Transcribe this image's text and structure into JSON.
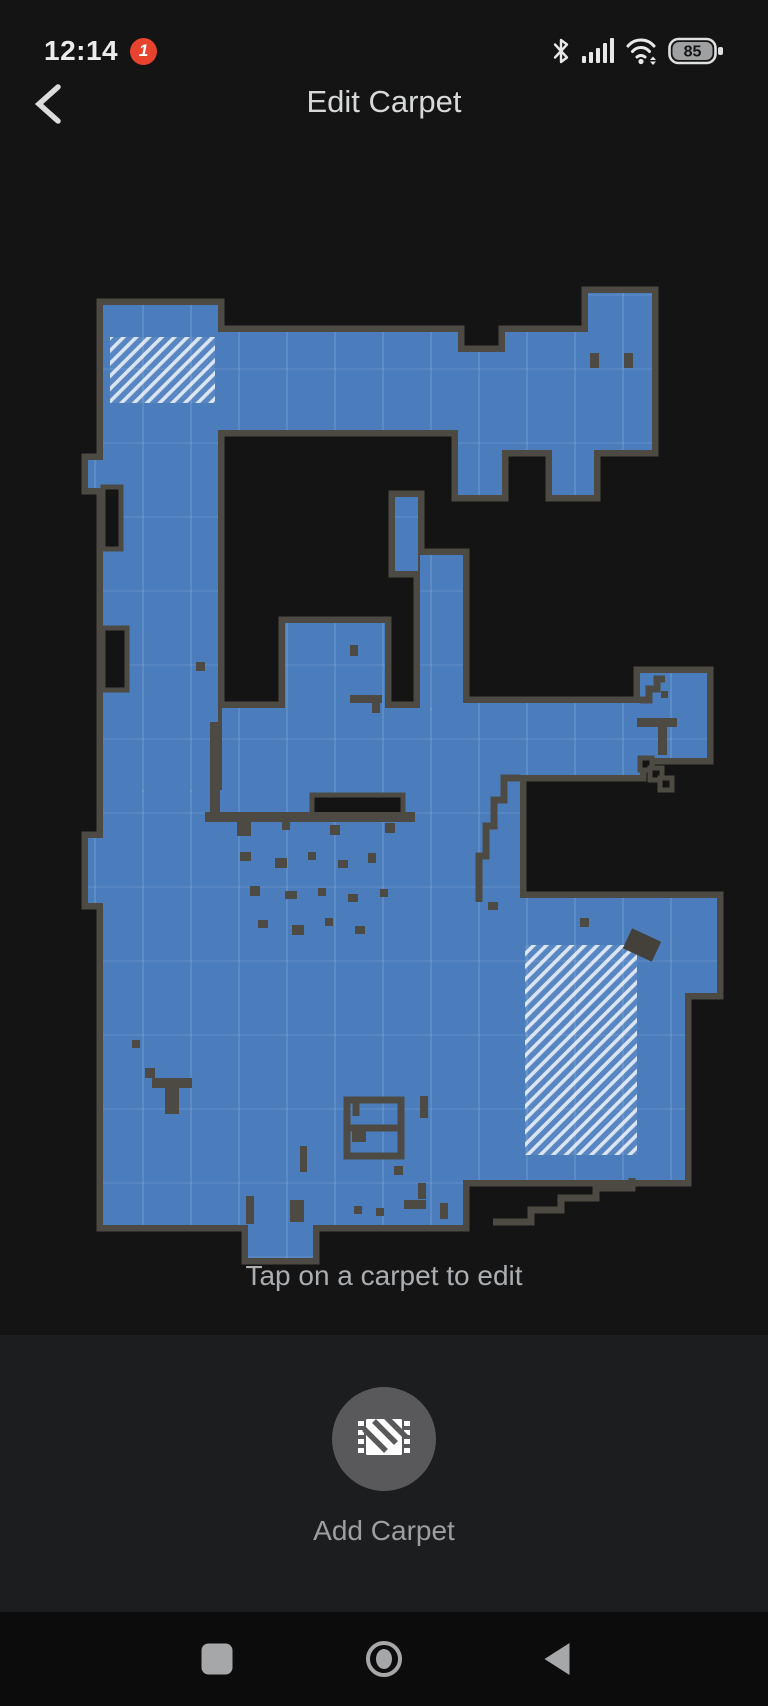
{
  "status_bar": {
    "time": "12:14",
    "notification_badge": "1",
    "battery_percent": "85",
    "icons": [
      "bluetooth-icon",
      "signal-icon",
      "wifi-icon",
      "battery-icon"
    ]
  },
  "header": {
    "title": "Edit Carpet"
  },
  "map": {
    "hint": "Tap on a carpet to edit",
    "colors": {
      "background": "#141414",
      "floor": "#4b7dbd",
      "wall": "#4d4a43",
      "grid_v": "rgba(215,228,240,0.13)",
      "grid_h": "rgba(215,228,240,0.08)",
      "carpet_stripe": "rgba(255,255,255,0.78)",
      "smudge": "#44413a"
    },
    "floors": [
      [
        103,
        305,
        115,
        125
      ],
      [
        218,
        332,
        240,
        98
      ],
      [
        458,
        352,
        47,
        98
      ],
      [
        505,
        332,
        83,
        118
      ],
      [
        588,
        293,
        64,
        157
      ],
      [
        458,
        450,
        44,
        45
      ],
      [
        552,
        450,
        42,
        45
      ],
      [
        103,
        430,
        115,
        362
      ],
      [
        88,
        460,
        15,
        28
      ],
      [
        88,
        838,
        15,
        65
      ],
      [
        395,
        497,
        23,
        74
      ],
      [
        420,
        555,
        43,
        155
      ],
      [
        285,
        623,
        100,
        85
      ],
      [
        222,
        708,
        241,
        82
      ],
      [
        103,
        790,
        360,
        435
      ],
      [
        463,
        703,
        177,
        72
      ],
      [
        640,
        673,
        67,
        85
      ],
      [
        463,
        775,
        57,
        123
      ],
      [
        463,
        898,
        254,
        95
      ],
      [
        463,
        993,
        222,
        187
      ],
      [
        248,
        1225,
        65,
        33
      ]
    ],
    "carpets": [
      {
        "id": "carpet-1",
        "rect": [
          110,
          337,
          105,
          66
        ]
      },
      {
        "id": "carpet-2",
        "rect": [
          525,
          945,
          112,
          210
        ]
      }
    ],
    "carpet_smudge": {
      "rect": [
        626,
        934,
        32,
        22
      ],
      "rotate": 25
    },
    "dark_areas": [
      [
        103,
        487,
        18,
        62
      ],
      [
        103,
        628,
        24,
        62
      ],
      [
        312,
        795,
        91,
        22
      ],
      [
        640,
        758,
        12,
        12
      ],
      [
        650,
        768,
        12,
        12
      ],
      [
        660,
        778,
        12,
        12
      ]
    ],
    "obstacles": [
      [
        590,
        353,
        9,
        15
      ],
      [
        624,
        353,
        9,
        15
      ],
      [
        637,
        718,
        40,
        9
      ],
      [
        658,
        727,
        9,
        28
      ],
      [
        661,
        691,
        7,
        7
      ],
      [
        350,
        645,
        8,
        11
      ],
      [
        350,
        695,
        32,
        8
      ],
      [
        372,
        703,
        8,
        10
      ],
      [
        210,
        722,
        10,
        100
      ],
      [
        205,
        812,
        210,
        10
      ],
      [
        237,
        818,
        14,
        18
      ],
      [
        282,
        822,
        8,
        8
      ],
      [
        330,
        825,
        10,
        10
      ],
      [
        385,
        823,
        10,
        10
      ],
      [
        240,
        852,
        11,
        9
      ],
      [
        275,
        858,
        12,
        10
      ],
      [
        308,
        852,
        8,
        8
      ],
      [
        338,
        860,
        10,
        8
      ],
      [
        368,
        853,
        8,
        10
      ],
      [
        250,
        886,
        10,
        10
      ],
      [
        285,
        891,
        12,
        8
      ],
      [
        318,
        888,
        8,
        8
      ],
      [
        348,
        894,
        10,
        8
      ],
      [
        380,
        889,
        8,
        8
      ],
      [
        258,
        920,
        10,
        8
      ],
      [
        292,
        925,
        12,
        10
      ],
      [
        325,
        918,
        8,
        8
      ],
      [
        355,
        926,
        10,
        8
      ],
      [
        152,
        1078,
        40,
        10
      ],
      [
        165,
        1088,
        14,
        26
      ],
      [
        145,
        1068,
        10,
        10
      ],
      [
        132,
        1040,
        8,
        8
      ],
      [
        352,
        1128,
        14,
        14
      ],
      [
        394,
        1166,
        9,
        9
      ],
      [
        418,
        1183,
        8,
        16
      ],
      [
        246,
        1196,
        8,
        28
      ],
      [
        290,
        1200,
        14,
        22
      ],
      [
        354,
        1206,
        8,
        8
      ],
      [
        376,
        1208,
        8,
        8
      ],
      [
        404,
        1200,
        22,
        9
      ],
      [
        440,
        1203,
        8,
        16
      ],
      [
        580,
        918,
        9,
        9
      ],
      [
        488,
        902,
        10,
        8
      ],
      [
        196,
        662,
        9,
        9
      ],
      [
        300,
        1146,
        7,
        26
      ],
      [
        420,
        1096,
        8,
        22
      ]
    ],
    "wall_paths": [
      "M520 778 L504 778 L504 800 L494 800 L494 826 L486 826 L486 856 L479 856 L479 902",
      "M493 1222 L531 1222 L531 1210 L561 1210 L561 1198 L596 1198 L596 1188 L632 1188 L632 1178",
      "M640 700 L649 700 L649 689 L657 689 L657 679 L665 679",
      "M347 1100 L401 1100 L401 1156 L347 1156 Z",
      "M347 1128 L401 1128",
      "M356 1100 L356 1116"
    ]
  },
  "panel": {
    "add_carpet_label": "Add Carpet",
    "button_icon": "carpet-icon"
  },
  "nav_bar": {
    "icons": [
      "recents-icon",
      "home-icon",
      "back-icon"
    ]
  }
}
